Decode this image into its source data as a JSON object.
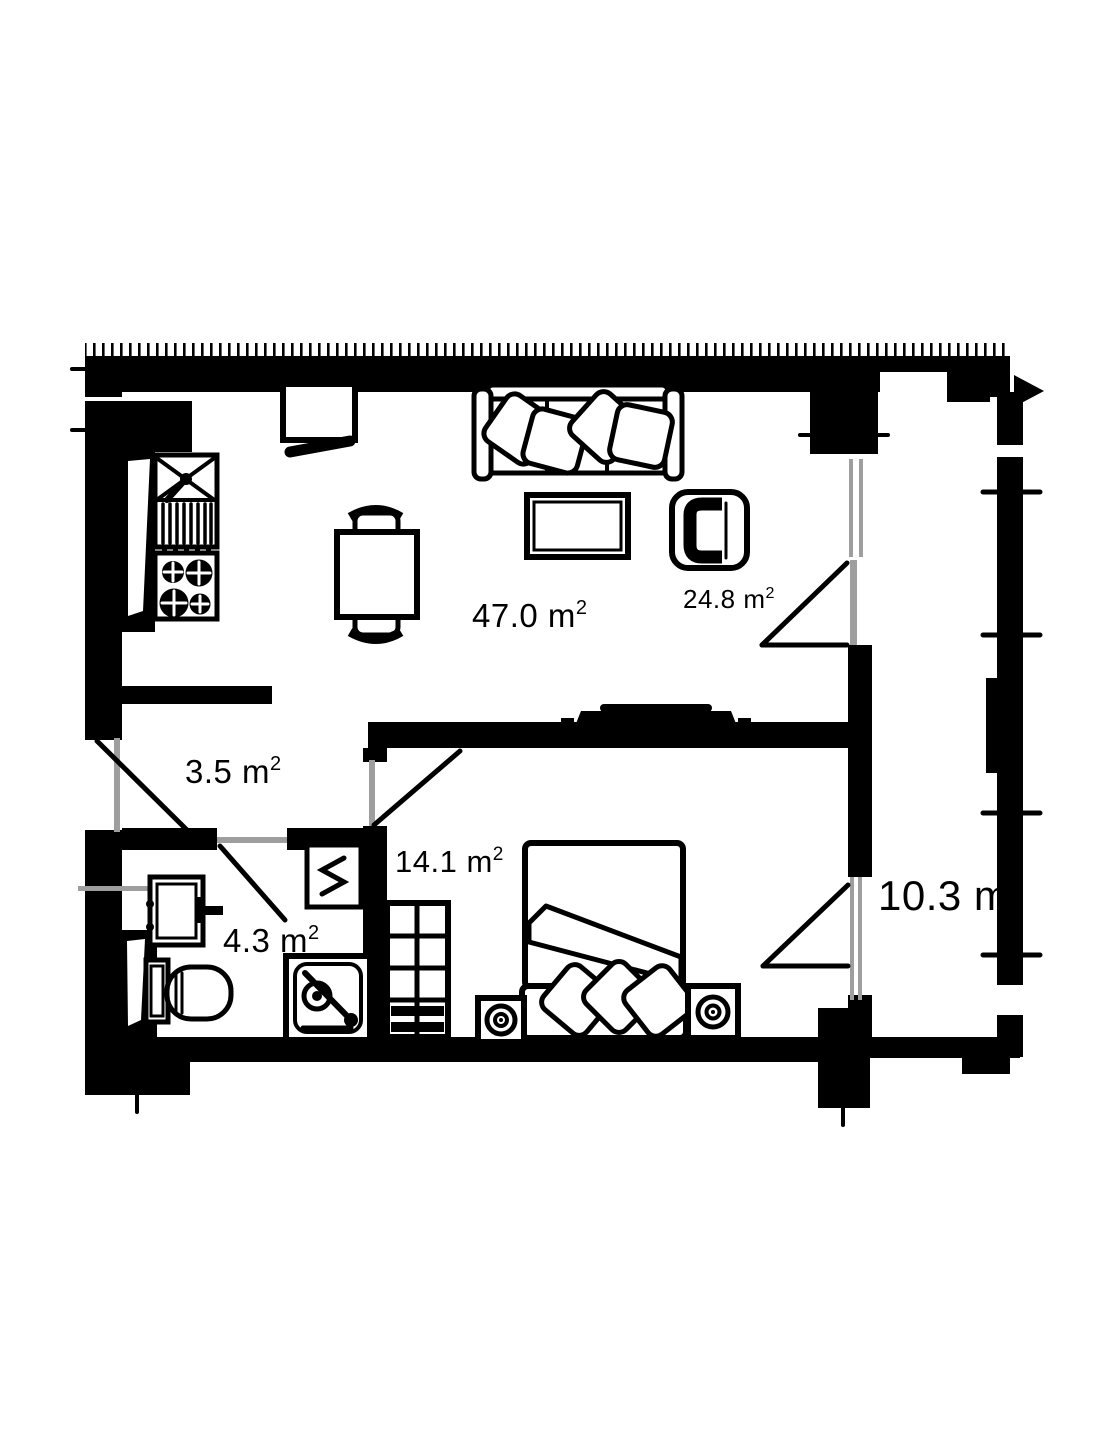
{
  "colors": {
    "paper": "#ffffff",
    "ink": "#000000",
    "frame": "#9e9e9e"
  },
  "plan": {
    "rooms": {
      "living_room": {
        "area": "47.0 m",
        "sup": "2"
      },
      "lounge": {
        "area": "24.8 m",
        "sup": "2"
      },
      "hallway": {
        "area": "3.5 m",
        "sup": "2"
      },
      "bedroom": {
        "area": "14.1 m",
        "sup": "2"
      },
      "bathroom": {
        "area": "4.3 m",
        "sup": "2"
      },
      "balcony": {
        "area": "10.3 m",
        "sup": ""
      }
    }
  }
}
